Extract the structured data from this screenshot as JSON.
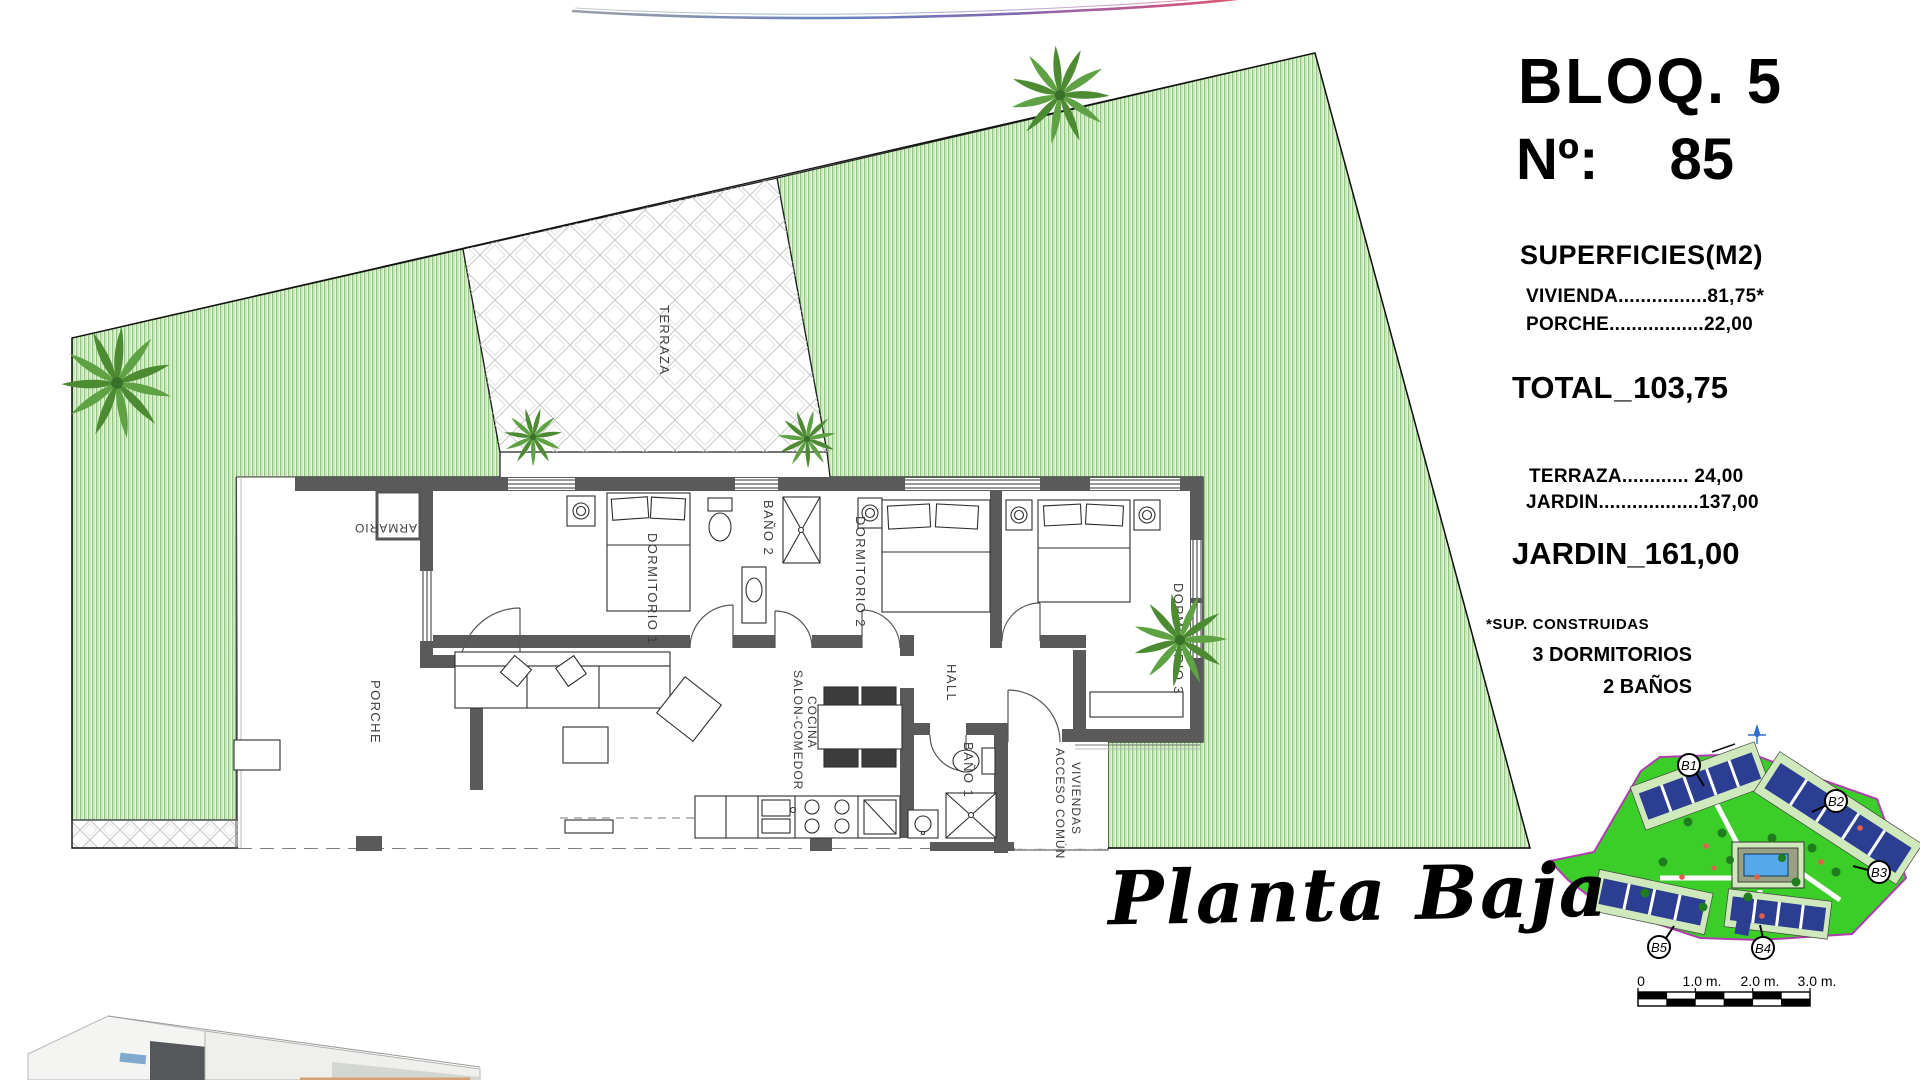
{
  "panel": {
    "bloq": "BLOQ. 5",
    "num_label": "Nº:",
    "num_value": "85",
    "superficies_heading": "SUPERFICIES(M2)",
    "rows": [
      {
        "label": "VIVIENDA",
        "leader": "................",
        "value": "81,75*"
      },
      {
        "label": "PORCHE",
        "leader": ".................",
        "value": "22,00"
      }
    ],
    "total_label": "TOTAL",
    "total_dash": "_",
    "total_value": "103,75",
    "outdoor_rows": [
      {
        "label": "TERRAZA",
        "leader": "............ ",
        "value": "24,00"
      },
      {
        "label": "JARDIN",
        "leader": "..................",
        "value": "137,00"
      }
    ],
    "jardin_label": "JARDIN",
    "jardin_dash": "_",
    "jardin_value": "161,00",
    "footnote": "*SUP. CONSTRUIDAS",
    "features": [
      "3 DORMITORIOS",
      "2 BAÑOS"
    ]
  },
  "plan": {
    "caption": "Planta Baja",
    "rooms": {
      "terraza": "TERRAZA",
      "armario": "ARMARIO",
      "dormitorio1": "DORMITORIO 1",
      "bano2": "BAÑO 2",
      "dormitorio2": "DORMITORIO 2",
      "dormitorio3": "DORMITORIO 3",
      "hall": "HALL",
      "salon_line1": "SALON-COMEDOR",
      "salon_line2": "COCINA",
      "bano1": "BAÑO 1",
      "porche": "PORCHE",
      "acceso_line1": "ACCESO COMÚN",
      "acceso_line2": "VIVIENDAS"
    }
  },
  "sitemap": {
    "labels": [
      "B1",
      "B2",
      "B3",
      "B4",
      "B5"
    ],
    "scale_ticks": [
      "0",
      "1.0 m.",
      "2.0 m.",
      "3.0 m."
    ]
  },
  "colors": {
    "grass_bg": "#e3f3d8",
    "grass_stripe": "#8fc87e",
    "wall_gray": "#5a5a5a",
    "site_green": "#3bcd28",
    "site_border": "#b13db1",
    "building_navy": "#2b3e92",
    "pool_blue": "#56a8e8"
  }
}
